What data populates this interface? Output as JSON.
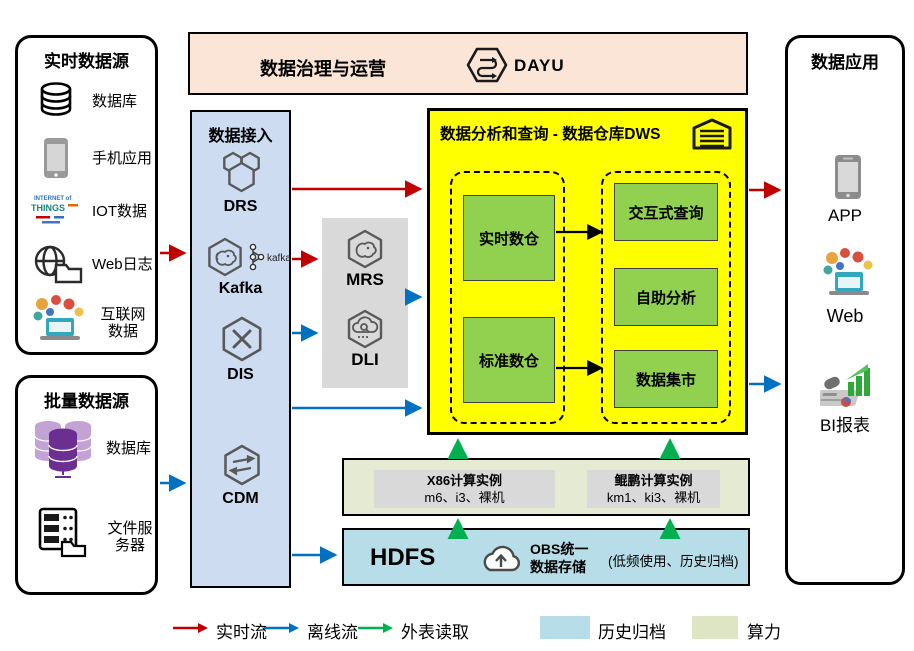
{
  "governance": {
    "title": "数据治理与运营",
    "product_label": "DAYU"
  },
  "realtime_sources": {
    "title": "实时数据源",
    "items": [
      {
        "label": "数据库",
        "icon": "database-icon"
      },
      {
        "label": "手机应用",
        "icon": "mobile-phone-icon"
      },
      {
        "label": "IOT数据",
        "icon": "iot-wordcloud-icon"
      },
      {
        "label": "Web日志",
        "icon": "web-log-icon"
      },
      {
        "label": "互联网数据",
        "icon": "internet-data-icon"
      }
    ]
  },
  "batch_sources": {
    "title": "批量数据源",
    "items": [
      {
        "label": "数据库",
        "icon": "purple-database-icon"
      },
      {
        "label": "文件服务器",
        "icon": "file-server-icon"
      }
    ]
  },
  "ingestion": {
    "title": "数据接入",
    "services": [
      {
        "name": "DRS"
      },
      {
        "name": "Kafka",
        "logo_text": "kafka"
      },
      {
        "name": "DIS"
      },
      {
        "name": "CDM"
      }
    ]
  },
  "processing": {
    "services": [
      {
        "name": "MRS"
      },
      {
        "name": "DLI"
      }
    ]
  },
  "dws": {
    "title": "数据分析和查询 - 数据仓库DWS",
    "warehouses": [
      "实时数仓",
      "标准数仓"
    ],
    "services": [
      "交互式查询",
      "自助分析",
      "数据集市"
    ]
  },
  "compute": {
    "instances": [
      {
        "name": "X86计算实例",
        "specs": "m6、i3、裸机"
      },
      {
        "name": "鲲鹏计算实例",
        "specs": "km1、ki3、裸机"
      }
    ]
  },
  "storage": {
    "hdfs_label": "HDFS",
    "obs_line1": "OBS统一",
    "obs_line2": "数据存储",
    "note": "(低频使用、历史归档)"
  },
  "applications": {
    "title": "数据应用",
    "items": [
      {
        "label": "APP"
      },
      {
        "label": "Web"
      },
      {
        "label": "BI报表"
      }
    ]
  },
  "legend": {
    "items": [
      {
        "label": "实时流",
        "type": "arrow",
        "color": "#C00000"
      },
      {
        "label": "离线流",
        "type": "arrow",
        "color": "#0070C0"
      },
      {
        "label": "外表读取",
        "type": "arrow",
        "color": "#00B050"
      },
      {
        "label": "历史归档",
        "type": "swatch",
        "color": "#B7DEE8"
      },
      {
        "label": "算力",
        "type": "swatch",
        "color": "#DDE5C5"
      }
    ]
  },
  "colors": {
    "realtime_flow": "#C00000",
    "offline_flow": "#0070C0",
    "external_read": "#00B050",
    "dws_bg": "#FFFF00",
    "node_green": "#92D050",
    "ingest_bg": "#CDDCF1",
    "banner_bg": "#FBE5D6",
    "hdfs_bg": "#B7DEE8",
    "compute_bg": "#E5EBD3"
  }
}
